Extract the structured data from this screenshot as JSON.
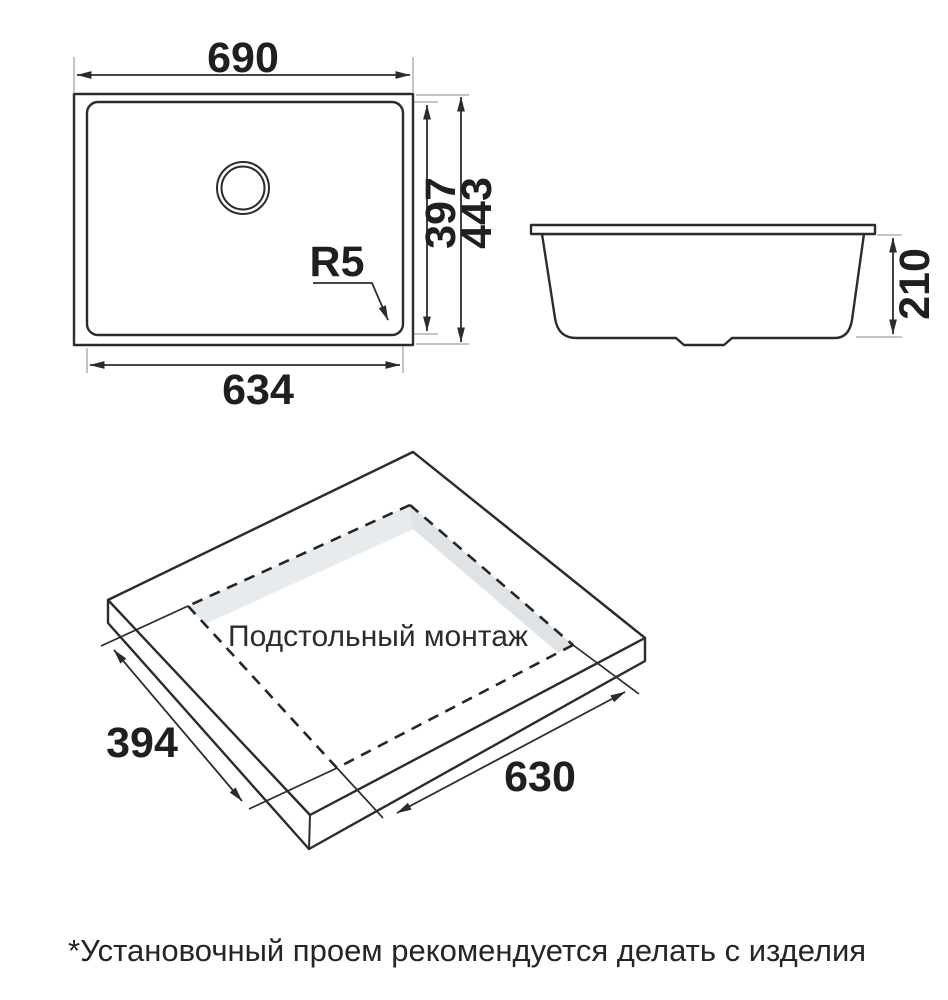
{
  "drawing": {
    "top_view": {
      "width_top": "690",
      "basin_height": "397",
      "overall_height": "443",
      "basin_width": "634",
      "corner_radius": "R5"
    },
    "side_view": {
      "height": "210"
    },
    "install_view": {
      "label": "Подстольный монтаж",
      "cutout_depth": "394",
      "cutout_width": "630"
    },
    "footnote": "*Установочный проем рекомендуется делать с изделия",
    "colors": {
      "ink": "#2a2c2e",
      "extension_line": "#aeb1b4",
      "slab_top": "#f2f4f5",
      "slab_side_left": "#e7eaec",
      "slab_side_right": "#edf0f1",
      "cutout_wall_ne": "#dfe3e5",
      "cutout_wall_nw": "#e8ebed"
    }
  }
}
